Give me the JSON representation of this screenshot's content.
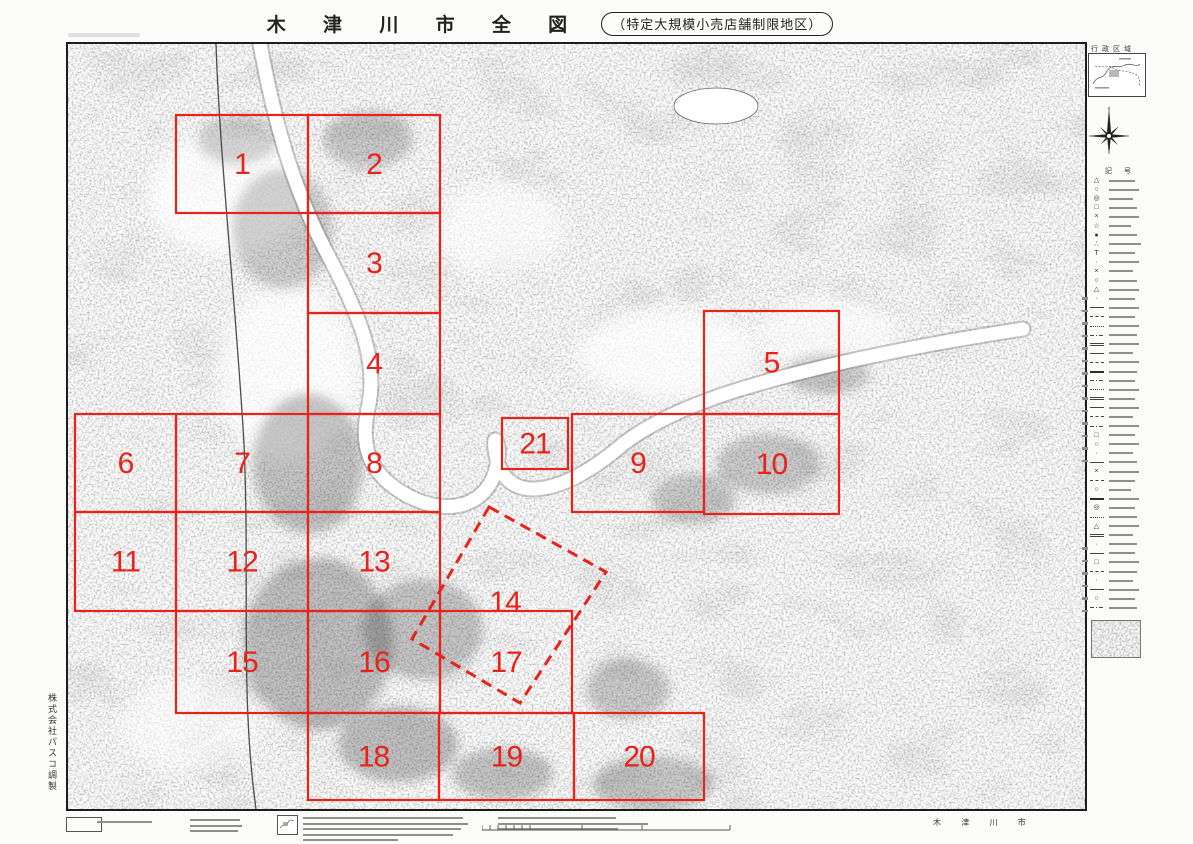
{
  "colors": {
    "overlay_red": "#e8231c",
    "ink": "#1d1d1d"
  },
  "header": {
    "title": "木 津 川 市 全 図",
    "subtitle": "（特定大規模小売店舗制限地区）"
  },
  "map": {
    "regions": [
      {
        "id": "1",
        "x": 108,
        "y": 71,
        "w": 132,
        "h": 98
      },
      {
        "id": "2",
        "x": 240,
        "y": 71,
        "w": 132,
        "h": 98
      },
      {
        "id": "3",
        "x": 240,
        "y": 169,
        "w": 132,
        "h": 100
      },
      {
        "id": "4",
        "x": 240,
        "y": 269,
        "w": 132,
        "h": 101
      },
      {
        "id": "5",
        "x": 636,
        "y": 267,
        "w": 135,
        "h": 103
      },
      {
        "id": "6",
        "x": 7,
        "y": 370,
        "w": 101,
        "h": 98
      },
      {
        "id": "7",
        "x": 108,
        "y": 370,
        "w": 132,
        "h": 98
      },
      {
        "id": "8",
        "x": 240,
        "y": 370,
        "w": 132,
        "h": 98
      },
      {
        "id": "9",
        "x": 504,
        "y": 370,
        "w": 132,
        "h": 98
      },
      {
        "id": "10",
        "x": 636,
        "y": 370,
        "w": 135,
        "h": 100
      },
      {
        "id": "11",
        "x": 7,
        "y": 468,
        "w": 101,
        "h": 99
      },
      {
        "id": "12",
        "x": 108,
        "y": 468,
        "w": 132,
        "h": 99
      },
      {
        "id": "13",
        "x": 240,
        "y": 468,
        "w": 132,
        "h": 99
      },
      {
        "id": "15",
        "x": 108,
        "y": 567,
        "w": 132,
        "h": 102
      },
      {
        "id": "16",
        "x": 240,
        "y": 567,
        "w": 132,
        "h": 102
      },
      {
        "id": "17",
        "x": 372,
        "y": 567,
        "w": 132,
        "h": 102
      },
      {
        "id": "18",
        "x": 240,
        "y": 669,
        "w": 131,
        "h": 87
      },
      {
        "id": "19",
        "x": 371,
        "y": 669,
        "w": 135,
        "h": 87
      },
      {
        "id": "20",
        "x": 506,
        "y": 669,
        "w": 130,
        "h": 87
      },
      {
        "id": "21",
        "x": 434,
        "y": 374,
        "w": 66,
        "h": 51
      }
    ],
    "dashed_region": {
      "id": "14",
      "points": "421,463 538,528 452,659 344,595",
      "label_x": 437,
      "label_y": 568
    }
  },
  "sidebar": {
    "inset_title": "行政区域",
    "legend_title": "記 号",
    "legend_rows": [
      [
        "t",
        "△",
        26
      ],
      [
        "t",
        "○",
        30
      ],
      [
        "t",
        "◎",
        24
      ],
      [
        "t",
        "□",
        28
      ],
      [
        "t",
        "×",
        30
      ],
      [
        "t",
        "☆",
        22
      ],
      [
        "t",
        "●",
        28
      ],
      [
        "t",
        "∴",
        32
      ],
      [
        "t",
        "T",
        26
      ],
      [
        "t",
        "·",
        30
      ],
      [
        "t",
        "×",
        24
      ],
      [
        "t",
        "○",
        28
      ],
      [
        "t",
        "△",
        30
      ],
      [
        "t",
        "·",
        26
      ],
      [
        "l",
        "solid",
        30
      ],
      [
        "l",
        "dash",
        26
      ],
      [
        "l",
        "dot",
        30
      ],
      [
        "l",
        "dashdot",
        28
      ],
      [
        "l",
        "double",
        30
      ],
      [
        "l",
        "solid",
        24
      ],
      [
        "l",
        "dash",
        30
      ],
      [
        "l",
        "thick",
        28
      ],
      [
        "l",
        "dashdot",
        26
      ],
      [
        "l",
        "dot",
        30
      ],
      [
        "l",
        "double",
        26
      ],
      [
        "l",
        "solid",
        30
      ],
      [
        "l",
        "dash",
        24
      ],
      [
        "l",
        "dashdot",
        30
      ],
      [
        "t",
        "□",
        26
      ],
      [
        "t",
        "○",
        30
      ],
      [
        "t",
        "·",
        24
      ],
      [
        "l",
        "solid",
        28
      ],
      [
        "t",
        "×",
        30
      ],
      [
        "l",
        "dash",
        26
      ],
      [
        "t",
        "○",
        22
      ],
      [
        "l",
        "thick",
        30
      ],
      [
        "t",
        "◎",
        26
      ],
      [
        "l",
        "dot",
        28
      ],
      [
        "t",
        "△",
        30
      ],
      [
        "l",
        "double",
        24
      ],
      [
        "t",
        "·",
        28
      ],
      [
        "l",
        "solid",
        26
      ],
      [
        "t",
        "□",
        30
      ],
      [
        "l",
        "dash",
        28
      ],
      [
        "t",
        "·",
        24
      ],
      [
        "l",
        "solid",
        30
      ],
      [
        "t",
        "○",
        26
      ],
      [
        "l",
        "dashdot",
        28
      ]
    ],
    "bracket_cols": [
      {
        "left": -3,
        "top": 255,
        "bars": 14
      },
      {
        "left": -3,
        "top": 505,
        "bars": 6
      }
    ]
  },
  "footer": {
    "city": "木 津 川 市",
    "credit": "株式会社パスコ調製",
    "scale_ticks": [
      0,
      8,
      16,
      24,
      32,
      40,
      48,
      100,
      160,
      248
    ],
    "note_blocks": [
      {
        "x": 31,
        "y": 8,
        "lines": [
          55
        ]
      },
      {
        "x": 124,
        "y": 6,
        "lines": [
          50,
          52,
          48
        ]
      },
      {
        "x": 237,
        "y": 4,
        "lines": [
          160,
          165,
          158,
          150,
          95
        ]
      },
      {
        "x": 432,
        "y": 4,
        "lines": [
          118,
          150,
          120
        ]
      }
    ]
  }
}
